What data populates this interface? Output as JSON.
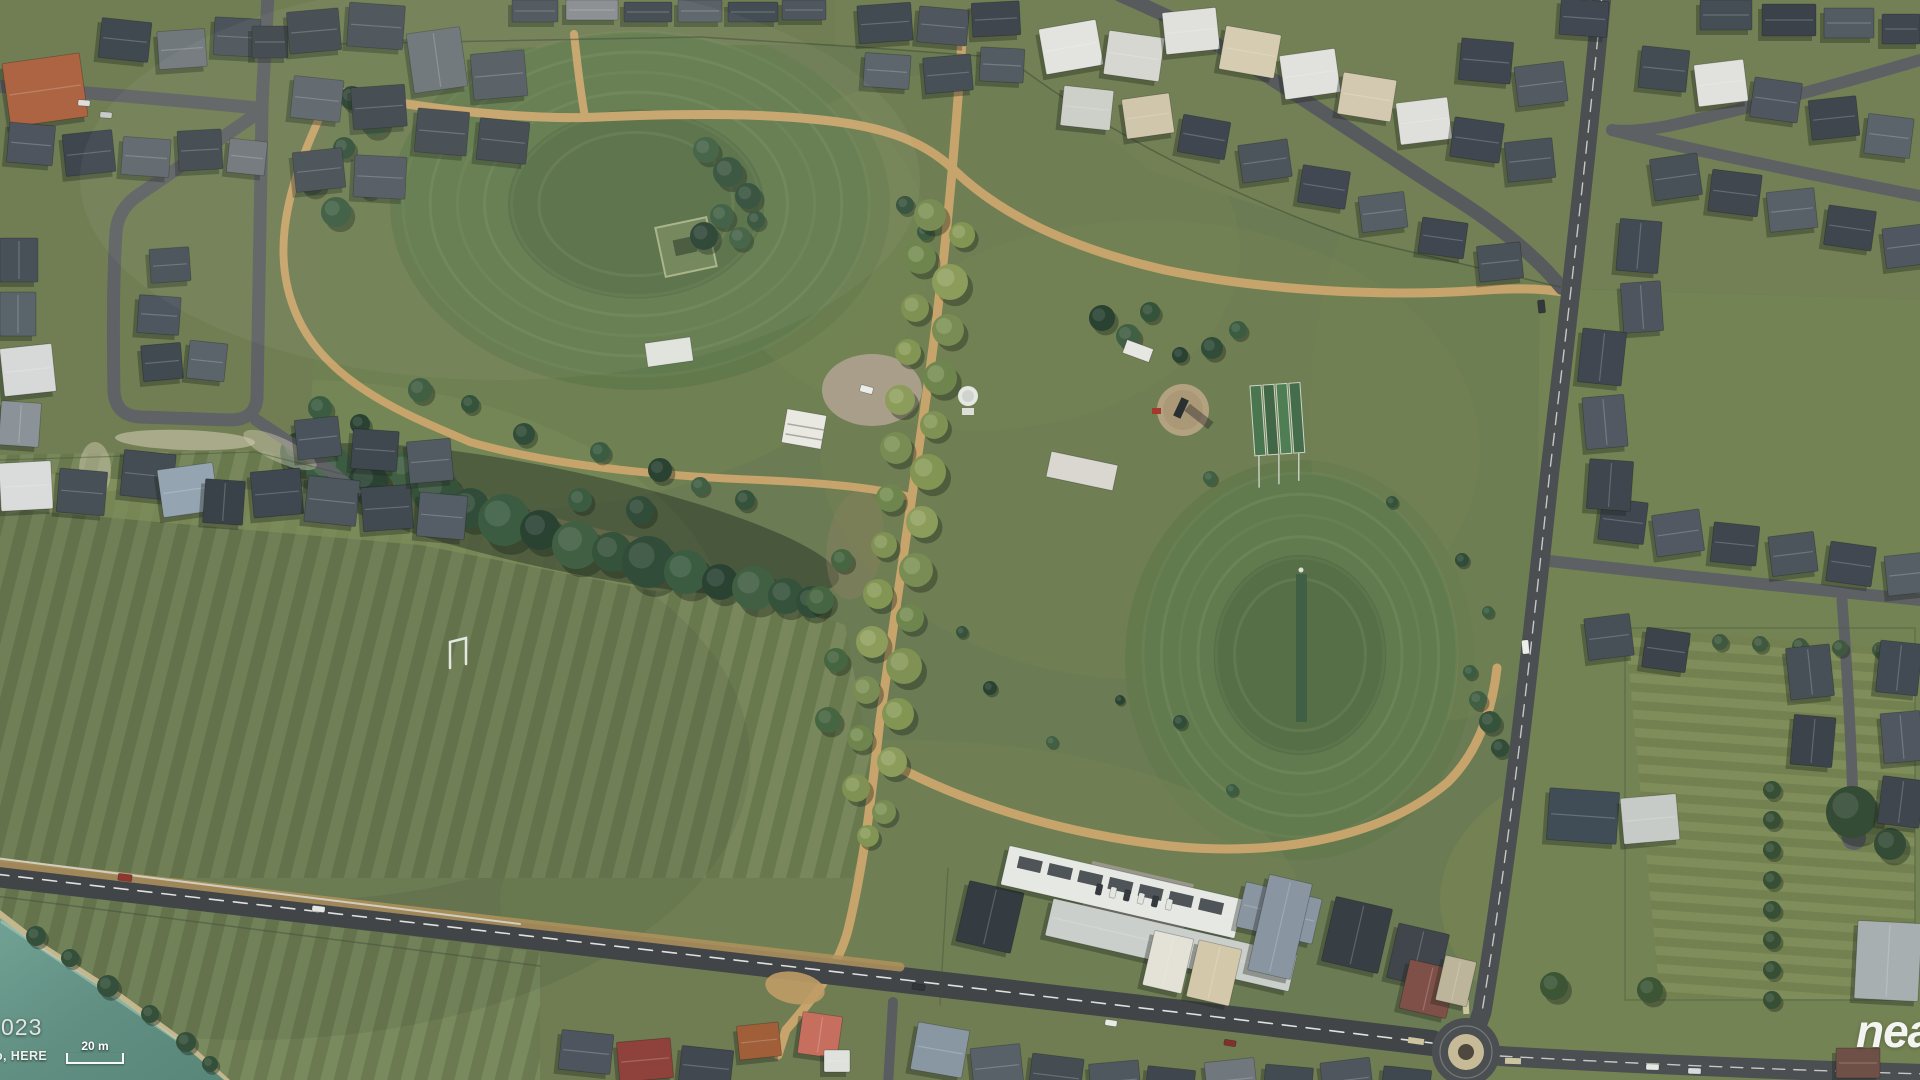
{
  "overlay": {
    "watermark_fragment": "nea",
    "attribution_year_fragment": "023",
    "attribution_source_fragment": "o, HERE",
    "scale_bar_label": "20 m"
  },
  "map": {
    "kind": "aerial satellite imagery",
    "scene_description": "Suburban park with two circular grass sports ovals, a tree-lined avenue path, creek tree corridor, open striped paddocks, a farm pond, school buildings, a roundabout and surrounding residential streets",
    "palette": {
      "grass_base": "#68784f",
      "oval_grass": "#5e7849",
      "path_tan": "#c9a368",
      "road_asphalt": "#46494d",
      "street_asphalt": "#5b5e61",
      "pond_water": "#5d8d80",
      "pond_bank": "#c6b68c",
      "tree_dark": "#2f4c35",
      "avenue_tree": "#7d8f4f",
      "roof_dark": "#394049",
      "roof_light": "#e4e4e1",
      "roof_terracotta": "#ad5f3d",
      "roof_red": "#8e3b35",
      "roundabout_center": "#c9bb96"
    }
  }
}
